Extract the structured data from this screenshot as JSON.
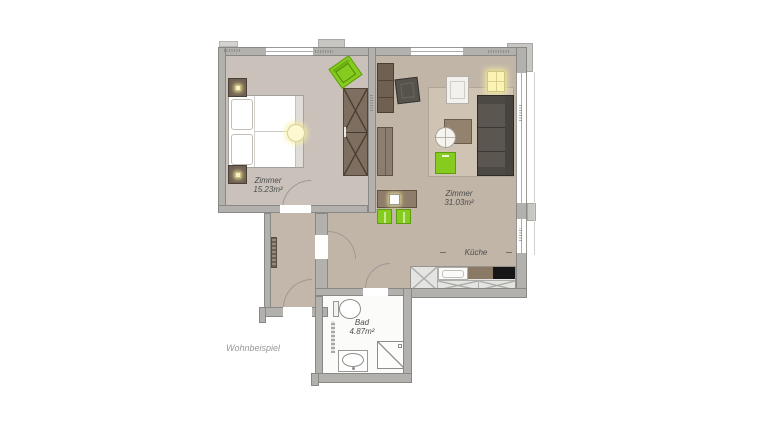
{
  "title": "Wohnbeispiel floor plan",
  "caption": "Wohnbeispiel",
  "rooms": {
    "bedroom": {
      "label": "Zimmer",
      "area": "15.23m²"
    },
    "living": {
      "label": "Zimmer",
      "area": "31.03m²"
    },
    "kitchen": {
      "label": "Küche"
    },
    "bath": {
      "label": "Bad",
      "area": "4.87m²"
    }
  },
  "colors": {
    "wall": "#b3b1ae",
    "bedroom_floor": "#cac2ba",
    "living_floor": "#c1b5a8",
    "hall_floor": "#c3b6aa",
    "bath_floor": "#fbfbf9",
    "rug": "#cfc3b4",
    "furniture_brown_dark": "#6e6052",
    "furniture_brown": "#8d7d6a",
    "sofa_gray": "#5b5750",
    "accent_green": "#85cc1e",
    "lamp_yellow": "#fbf3b4",
    "counter_gray": "#e4e4e2",
    "cooktop_black": "#161616"
  },
  "furniture_icons": [
    "double-bed",
    "pillow",
    "nightstand",
    "table-lamp",
    "ceiling-lamp",
    "wardrobe",
    "armchair-green",
    "tall-cabinet",
    "low-cabinet",
    "armchair-gray",
    "armchair-white",
    "floor-lamp",
    "rug",
    "sofa",
    "side-table",
    "coffee-table",
    "green-sideboard",
    "dining-table",
    "green-chair",
    "kitchen-counter",
    "kitchen-sink",
    "cooktop",
    "toilet",
    "washbasin",
    "shower",
    "radiator",
    "door-swing"
  ]
}
